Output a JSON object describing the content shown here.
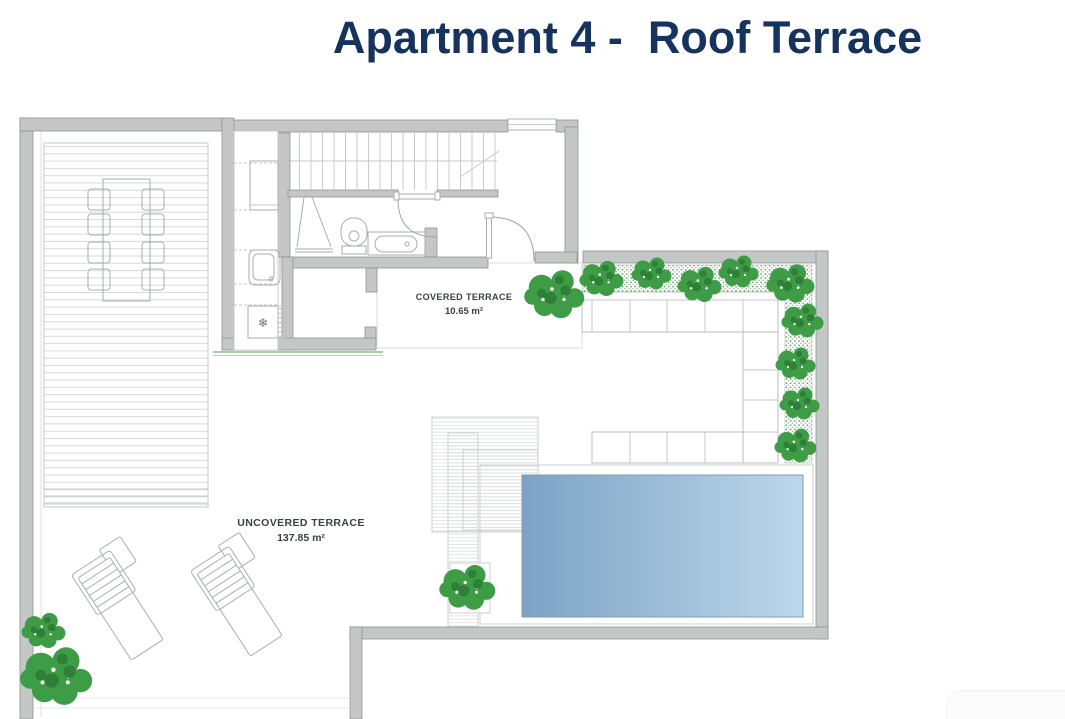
{
  "title": "Apartment 4 -  Roof Terrace",
  "labels": {
    "covered": {
      "name": "COVERED TERRACE",
      "area": "10.65 m²"
    },
    "uncovered": {
      "name": "UNCOVERED TERRACE",
      "area": "137.85 m²"
    }
  },
  "icons": {
    "freezer_snowflake": "❄"
  },
  "colors": {
    "title_navy": "#16335E",
    "wall_gray": "#C3C7C6",
    "wall_outline": "#8F9594",
    "plan_line": "#A9AEAE",
    "deck_line": "#D7DAD9",
    "bush_green": "#3E9C47",
    "bush_green_dark": "#2E7F38",
    "planter_dot_green": "#5F9E63",
    "pool_blue_left": "#7CA3C5",
    "pool_blue_right": "#BDD7EB",
    "glass_line_green": "#8FBC8F"
  }
}
